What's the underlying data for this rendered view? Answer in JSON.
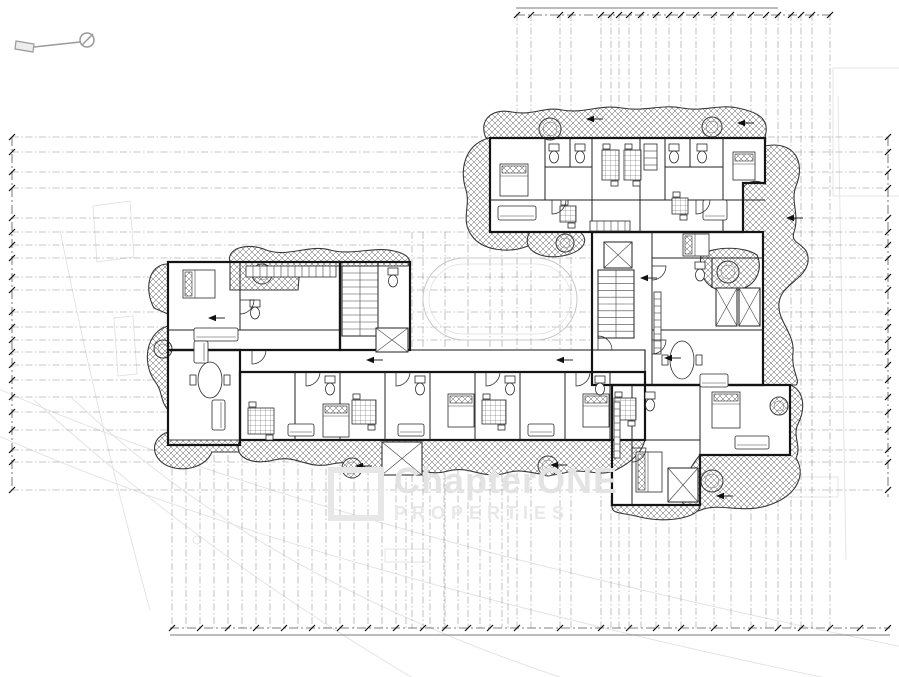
{
  "watermark": {
    "line1": "ChapterONE",
    "line2": "PROPERTIES"
  },
  "drawing": {
    "grid_v": [
      [
        517,
        14
      ],
      [
        531,
        14
      ],
      [
        560,
        14
      ],
      [
        571,
        14
      ],
      [
        601,
        14
      ],
      [
        611,
        14
      ],
      [
        619,
        14
      ],
      [
        629,
        14
      ],
      [
        641,
        14
      ],
      [
        656,
        14
      ],
      [
        669,
        14
      ],
      [
        681,
        14
      ],
      [
        696,
        14
      ],
      [
        714,
        14
      ],
      [
        731,
        14
      ],
      [
        751,
        14
      ],
      [
        766,
        14
      ],
      [
        778,
        14
      ],
      [
        791,
        14
      ],
      [
        801,
        14
      ],
      [
        812,
        14
      ],
      [
        830,
        14
      ],
      [
        412,
        232
      ],
      [
        423,
        232
      ],
      [
        445,
        232
      ],
      [
        468,
        232
      ],
      [
        490,
        232
      ],
      [
        502,
        232
      ],
      [
        172,
        455
      ],
      [
        186,
        455
      ],
      [
        200,
        455
      ],
      [
        214,
        455
      ],
      [
        228,
        455
      ],
      [
        242,
        455
      ],
      [
        256,
        455
      ],
      [
        270,
        455
      ],
      [
        284,
        455
      ],
      [
        298,
        455
      ],
      [
        312,
        455
      ],
      [
        326,
        455
      ],
      [
        340,
        455
      ],
      [
        354,
        455
      ],
      [
        368,
        455
      ],
      [
        382,
        455
      ],
      [
        396,
        455
      ],
      [
        406,
        455
      ],
      [
        430,
        455
      ],
      [
        444,
        455
      ],
      [
        458,
        455
      ],
      [
        480,
        455
      ],
      [
        508,
        455
      ]
    ],
    "grid_v_y2": 628,
    "grid_h": [
      137,
      152,
      172,
      188,
      218,
      232,
      245,
      258,
      277,
      290,
      312,
      327,
      340,
      352,
      365,
      380,
      397,
      412,
      430,
      450,
      462,
      490
    ],
    "grid_h_x": [
      12,
      888
    ],
    "dims": {
      "lines": [
        {
          "x1": 516,
          "y1": 8,
          "x2": 778,
          "y2": 8,
          "s": 1
        },
        {
          "x1": 516,
          "y1": 15,
          "x2": 832,
          "y2": 15
        },
        {
          "x1": 12,
          "y1": 137,
          "x2": 12,
          "y2": 490
        },
        {
          "x1": 888,
          "y1": 137,
          "x2": 888,
          "y2": 497
        },
        {
          "x1": 170,
          "y1": 628,
          "x2": 890,
          "y2": 628
        },
        {
          "x1": 170,
          "y1": 635,
          "x2": 890,
          "y2": 635,
          "s": 1
        }
      ],
      "ticks": [
        {
          "y": 15,
          "xs": [
            517,
            531,
            560,
            571,
            601,
            611,
            619,
            629,
            641,
            656,
            669,
            681,
            696,
            714,
            731,
            751,
            766,
            778,
            791,
            801,
            812,
            830
          ]
        },
        {
          "x": 12,
          "ys": [
            137,
            152,
            172,
            188,
            218,
            232,
            245,
            258,
            277,
            290,
            312,
            327,
            340,
            352,
            365,
            380,
            397,
            412,
            430,
            450,
            462,
            490
          ]
        },
        {
          "x": 888,
          "ys": [
            137,
            152,
            172,
            188,
            218,
            232,
            245,
            258,
            277,
            290,
            312,
            327,
            340,
            352,
            365,
            380,
            397,
            412,
            430,
            450,
            462,
            490
          ]
        },
        {
          "y": 628,
          "xs": [
            172,
            200,
            228,
            256,
            284,
            312,
            340,
            368,
            396,
            423,
            445,
            468,
            490,
            517,
            560,
            601,
            629,
            656,
            681,
            714,
            751,
            778,
            801,
            830,
            860,
            888
          ]
        }
      ]
    },
    "faint_paths": [
      "M-10 385 Q300 525 908 648",
      "M-10 432 Q300 572 908 695",
      "M34 400 Q210 560 430 688",
      "M72 398 Q270 588 600 690",
      "M60 230 Q100 430 150 610",
      "M838 96 L846 560",
      "M93 206 L130 201 L134 257 L97 262 Z",
      "M114 318 L133 316 L137 374 L118 376 Z"
    ],
    "faint_rects": [
      [
        833,
        68,
        72,
        128
      ],
      [
        710,
        477,
        128,
        20
      ],
      [
        385,
        549,
        45,
        13
      ]
    ],
    "faint_circles": [
      [
        197,
        540,
        4
      ]
    ],
    "pool": [
      [
        423,
        258,
        154,
        82,
        41
      ],
      [
        429,
        264,
        142,
        70,
        35
      ]
    ],
    "footprint": [
      {
        "d": "M490 138 L765 138 L765 183 L743 183 L743 232 L490 232 Z",
        "w": 2.2
      },
      {
        "d": "M592 232 L763 232 L763 385 L592 385 Z",
        "w": 2.2
      },
      {
        "d": "M612 385 L790 385 L790 455 L700 455 L700 505 L612 505 Z",
        "w": 2.2
      },
      {
        "d": "M168 262 L340 262 L340 350 L168 350 Z",
        "w": 2.2
      },
      {
        "d": "M168 350 L240 350 L240 445 L168 445 Z",
        "w": 2.2
      },
      {
        "d": "M340 262 L410 262 L410 350 L340 350 Z",
        "w": 2.2
      },
      {
        "d": "M240 350 L645 350 L645 372 L240 372 Z",
        "w": 1.1
      },
      {
        "d": "M240 372 L645 372 L645 440 L240 440 Z",
        "w": 2.2
      }
    ],
    "balconies": [
      "M486 138 C478 120 492 108 512 112 C534 116 544 106 562 110 C584 114 600 104 622 108 C646 112 660 104 682 108 C704 112 718 104 738 108 C757 112 768 118 766 132 L765 138 Z",
      "M490 138 C468 142 458 166 466 190 C471 206 460 220 472 236 C482 250 508 254 528 246 C542 240 538 231 526 232 L490 232 Z",
      "M765 146 C794 140 806 162 796 186 C790 202 800 214 794 232 C789 246 810 242 808 262 C805 280 781 284 779 303 C777 321 795 333 793 353 C791 371 801 381 796 385 L763 385 L763 232 L743 232 L743 188 C748 180 758 180 765 184 Z",
      "M701 255 C697 283 714 295 738 290 C757 286 763 269 757 255 C744 246 714 246 701 255 Z",
      "M790 385 C804 390 806 408 798 424 C792 436 802 446 796 458 C806 474 798 494 772 504 C745 515 719 502 701 510 C687 516 678 503 683 487 C687 473 693 463 700 455 L790 455 Z",
      "M612 505 L700 505 C701 517 668 524 640 517 C622 512 611 515 612 505 Z",
      "M530 232 C520 248 538 260 562 256 C584 252 590 240 580 232 Z",
      "M230 290 L230 262 C226 248 248 242 266 250 C288 258 308 244 330 250 C352 256 374 246 394 251 C408 254 412 260 408 266 L300 266 L298 290 Z",
      "M168 264 C148 264 144 290 154 308 L168 314 Z",
      "M168 326 C146 332 142 362 154 380 C163 391 160 401 168 410 Z",
      "M168 432 C150 438 150 458 168 466 C186 473 206 466 212 452 L240 452 L240 440 L168 440 Z",
      "M240 440 C232 456 250 466 274 460 C296 454 308 470 332 464 C354 458 366 474 390 468 C412 462 424 478 448 471 C470 465 482 480 506 473 C528 466 540 480 564 473 C586 467 598 478 616 470 C632 462 642 452 645 440 Z"
    ],
    "trees": [
      [
        550,
        129,
        11
      ],
      [
        712,
        127,
        10
      ],
      [
        262,
        274,
        10
      ],
      [
        163,
        349,
        9
      ],
      [
        352,
        468,
        10
      ],
      [
        548,
        466,
        10
      ],
      [
        712,
        481,
        11
      ],
      [
        728,
        272,
        11
      ],
      [
        565,
        243,
        9
      ],
      [
        779,
        406,
        9
      ]
    ],
    "partitions": [
      [
        545,
        138,
        545,
        200
      ],
      [
        570,
        138,
        570,
        167
      ],
      [
        592,
        138,
        592,
        232
      ],
      [
        640,
        138,
        640,
        232
      ],
      [
        665,
        138,
        665,
        200
      ],
      [
        690,
        138,
        690,
        167
      ],
      [
        723,
        138,
        723,
        232
      ],
      [
        545,
        167,
        592,
        167
      ],
      [
        665,
        167,
        723,
        167
      ],
      [
        490,
        200,
        765,
        200
      ],
      [
        652,
        232,
        652,
        385
      ],
      [
        652,
        258,
        763,
        258
      ],
      [
        652,
        330,
        763,
        330
      ],
      [
        712,
        258,
        712,
        288
      ],
      [
        632,
        385,
        632,
        505
      ],
      [
        700,
        385,
        700,
        505
      ],
      [
        632,
        440,
        700,
        440
      ],
      [
        168,
        330,
        340,
        330
      ],
      [
        240,
        262,
        240,
        330
      ],
      [
        378,
        262,
        378,
        350
      ],
      [
        295,
        372,
        295,
        440
      ],
      [
        340,
        372,
        340,
        440
      ],
      [
        385,
        372,
        385,
        440
      ],
      [
        430,
        372,
        430,
        440
      ],
      [
        475,
        372,
        475,
        440
      ],
      [
        520,
        372,
        520,
        440
      ],
      [
        565,
        372,
        565,
        440
      ],
      [
        610,
        372,
        610,
        440
      ]
    ],
    "stairs": [
      {
        "x": 342,
        "y": 266,
        "w": 36,
        "h": 70,
        "n": 9
      },
      {
        "x": 598,
        "y": 270,
        "w": 36,
        "h": 68,
        "n": 9
      }
    ],
    "xboxes": [
      [
        376,
        328,
        32,
        24
      ],
      [
        604,
        242,
        28,
        26
      ],
      [
        716,
        288,
        21,
        38
      ],
      [
        739,
        288,
        21,
        38
      ],
      [
        382,
        442,
        40,
        33
      ],
      [
        668,
        468,
        30,
        34
      ]
    ],
    "beds": [
      {
        "x": 500,
        "y": 164,
        "w": 28,
        "h": 32,
        "p": "top"
      },
      {
        "x": 733,
        "y": 152,
        "w": 22,
        "h": 28,
        "p": "top"
      },
      {
        "x": 183,
        "y": 270,
        "w": 32,
        "h": 28,
        "p": "left"
      },
      {
        "x": 323,
        "y": 404,
        "w": 26,
        "h": 33,
        "p": "top"
      },
      {
        "x": 448,
        "y": 394,
        "w": 26,
        "h": 33,
        "p": "top"
      },
      {
        "x": 583,
        "y": 394,
        "w": 26,
        "h": 33,
        "p": "top"
      },
      {
        "x": 683,
        "y": 234,
        "w": 26,
        "h": 22,
        "p": "left"
      },
      {
        "x": 636,
        "y": 452,
        "w": 26,
        "h": 40,
        "p": "left"
      },
      {
        "x": 712,
        "y": 392,
        "w": 28,
        "h": 36,
        "p": "top"
      }
    ],
    "tables": [
      {
        "x": 602,
        "y": 150,
        "w": 17,
        "h": 30
      },
      {
        "x": 624,
        "y": 150,
        "w": 17,
        "h": 30
      },
      {
        "x": 560,
        "y": 206,
        "w": 16,
        "h": 16
      },
      {
        "x": 672,
        "y": 198,
        "w": 16,
        "h": 16
      },
      {
        "x": 248,
        "y": 408,
        "w": 26,
        "h": 26
      },
      {
        "x": 352,
        "y": 400,
        "w": 24,
        "h": 24
      },
      {
        "x": 482,
        "y": 400,
        "w": 24,
        "h": 24
      },
      {
        "x": 614,
        "y": 398,
        "w": 22,
        "h": 22
      }
    ],
    "etables": [
      {
        "cx": 210,
        "cy": 380,
        "rx": 12,
        "ry": 18
      },
      {
        "cx": 682,
        "cy": 360,
        "rx": 12,
        "ry": 19
      }
    ],
    "sofas": [
      {
        "x": 498,
        "y": 206,
        "w": 38,
        "h": 14
      },
      {
        "x": 703,
        "y": 200,
        "w": 24,
        "h": 20
      },
      {
        "x": 194,
        "y": 328,
        "w": 44,
        "h": 13
      },
      {
        "x": 194,
        "y": 341,
        "w": 14,
        "h": 22
      },
      {
        "x": 288,
        "y": 424,
        "w": 26,
        "h": 12
      },
      {
        "x": 398,
        "y": 424,
        "w": 26,
        "h": 12
      },
      {
        "x": 528,
        "y": 424,
        "w": 26,
        "h": 12
      },
      {
        "x": 700,
        "y": 374,
        "w": 28,
        "h": 13
      },
      {
        "x": 735,
        "y": 436,
        "w": 34,
        "h": 13
      },
      {
        "x": 212,
        "y": 400,
        "w": 13,
        "h": 30
      }
    ],
    "wcs": [
      [
        549,
        144
      ],
      [
        575,
        144
      ],
      [
        669,
        144
      ],
      [
        697,
        144
      ],
      [
        695,
        262
      ],
      [
        645,
        392
      ],
      [
        325,
        376
      ],
      [
        415,
        376
      ],
      [
        505,
        376
      ],
      [
        595,
        376
      ],
      [
        388,
        268
      ],
      [
        250,
        300
      ]
    ],
    "kitchens": [
      {
        "x": 246,
        "y": 266,
        "w": 90,
        "h": 11
      },
      {
        "x": 654,
        "y": 292,
        "w": 7,
        "h": 62
      },
      {
        "x": 614,
        "y": 402,
        "w": 6,
        "h": 56
      },
      {
        "x": 590,
        "y": 221,
        "w": 40,
        "h": 10
      },
      {
        "x": 644,
        "y": 144,
        "w": 13,
        "h": 26
      }
    ],
    "doors": [
      "M306 372 L306 386 A14 14 0 0 0 320 372",
      "M396 372 L396 386 A14 14 0 0 0 410 372",
      "M486 372 L486 386 A14 14 0 0 0 500 372",
      "M576 372 L576 386 A14 14 0 0 0 590 372",
      "M552 200 L552 214 A14 14 0 0 0 566 200",
      "M696 200 L696 214 A14 14 0 0 0 710 200",
      "M240 300 L254 300 A14 14 0 0 1 240 314",
      "M652 266 L666 266 A14 14 0 0 1 652 280",
      "M652 340 L666 340 A14 14 0 0 1 652 354",
      "M632 448 L646 448 A14 14 0 0 1 632 462",
      "M598 350 L598 336 A14 14 0 0 1 612 350",
      "M252 350 L252 364 A14 14 0 0 0 266 350"
    ],
    "arrows": [
      [
        366,
        360
      ],
      [
        556,
        360
      ],
      [
        208,
        318
      ],
      [
        355,
        466
      ],
      [
        550,
        465
      ],
      [
        716,
        496
      ],
      [
        586,
        119
      ],
      [
        737,
        123
      ],
      [
        640,
        278
      ],
      [
        664,
        358
      ],
      [
        786,
        218
      ]
    ],
    "key_icon": {
      "circle": [
        87,
        40,
        7
      ],
      "lines": [
        [
          82,
          45,
          93,
          34
        ],
        [
          80,
          42,
          34,
          47
        ]
      ],
      "poly": "16,41 34,44 33,52 15,49"
    }
  }
}
